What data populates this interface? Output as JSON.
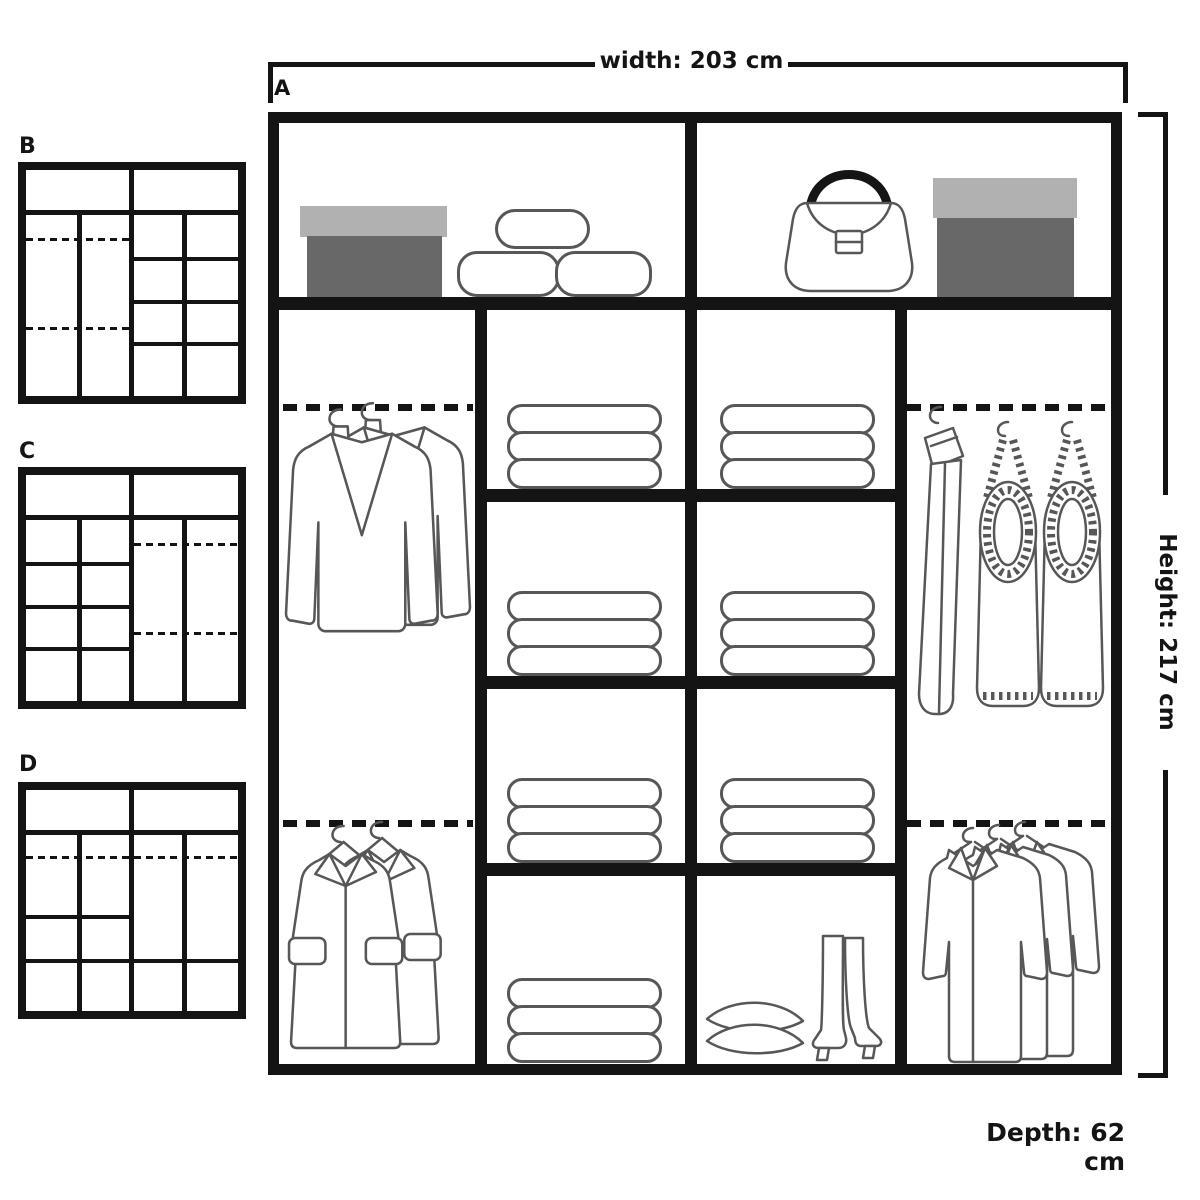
{
  "annotations": {
    "main_label": "A",
    "width_label": "width: 203 cm",
    "height_label": "Height: 217 cm",
    "depth_label": "Depth: 62 cm"
  },
  "thumbnails": [
    {
      "label": "B"
    },
    {
      "label": "C"
    },
    {
      "label": "D"
    }
  ],
  "colors": {
    "frame": "#141414",
    "line": "#575757",
    "box_lid": "#b1b1b1",
    "box_body": "#686868"
  },
  "contents": {
    "top_left_shelf": [
      "storage-box-icon",
      "duvet-stack-icon"
    ],
    "top_right_shelf": [
      "handbag-icon",
      "storage-box-icon"
    ],
    "left_column": [
      "hanging-jackets-icon",
      "hanging-coats-icon"
    ],
    "middle_left_column": [
      "folded-clothes-icon",
      "folded-clothes-icon",
      "folded-clothes-icon",
      "folded-clothes-icon"
    ],
    "middle_right_column": [
      "folded-clothes-icon",
      "folded-clothes-icon",
      "folded-clothes-icon",
      "pillows-icon",
      "boots-icon"
    ],
    "right_column": [
      "hanging-knitwear-icon",
      "hanging-shirts-icon"
    ]
  }
}
